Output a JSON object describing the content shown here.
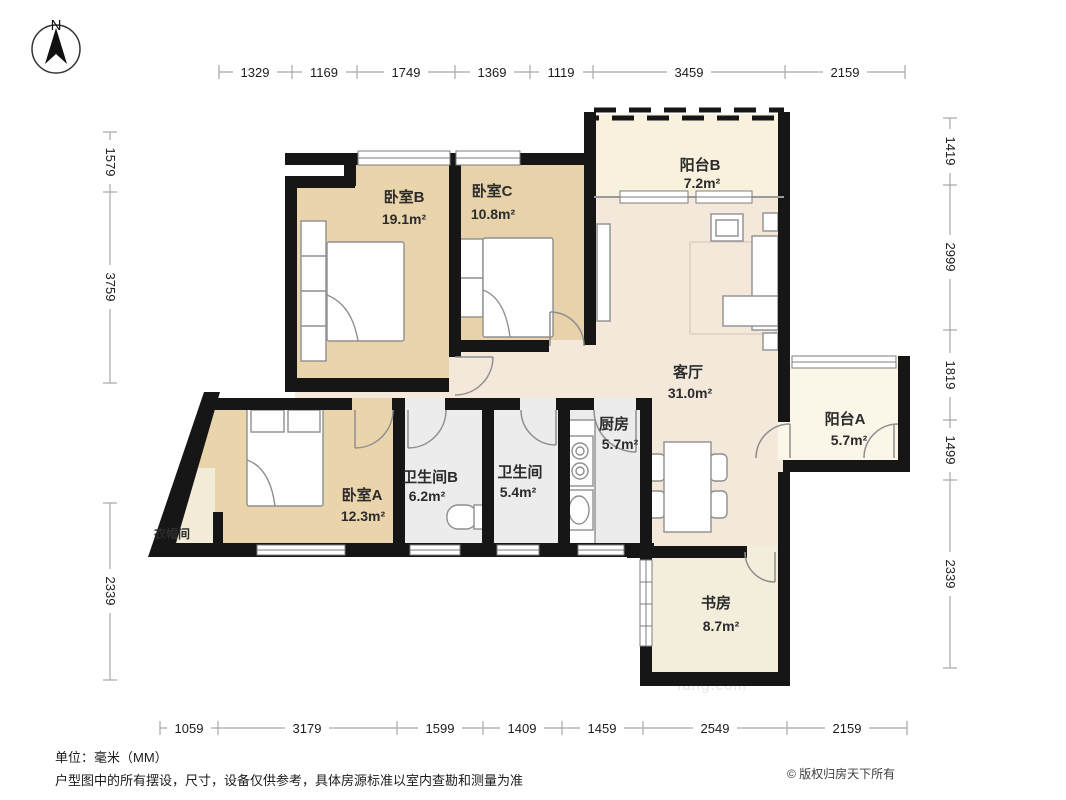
{
  "compass": {
    "north_label": "N"
  },
  "dimensions": {
    "unit_note": "单位：毫米（MM）",
    "top": [
      "1329",
      "1169",
      "1749",
      "1369",
      "1119",
      "3459",
      "2159"
    ],
    "bottom": [
      "1059",
      "3179",
      "1599",
      "1409",
      "1459",
      "2549",
      "2159"
    ],
    "left": [
      "1579",
      "3759",
      "2339"
    ],
    "right": [
      "1419",
      "2999",
      "1819",
      "1499",
      "2339"
    ]
  },
  "rooms": {
    "balcony_b": {
      "name": "阳台B",
      "area": "7.2m²"
    },
    "bedroom_b": {
      "name": "卧室B",
      "area": "19.1m²"
    },
    "bedroom_c": {
      "name": "卧室C",
      "area": "10.8m²"
    },
    "living": {
      "name": "客厅",
      "area": "31.0m²"
    },
    "balcony_a": {
      "name": "阳台A",
      "area": "5.7m²"
    },
    "kitchen": {
      "name": "厨房",
      "area": "5.7m²"
    },
    "bath_b": {
      "name": "卫生间B",
      "area": "6.2m²"
    },
    "bath": {
      "name": "卫生间",
      "area": "5.4m²"
    },
    "bedroom_a": {
      "name": "卧室A",
      "area": "12.3m²"
    },
    "cloakroom": {
      "name": "衣帽间"
    },
    "study": {
      "name": "书房",
      "area": "8.7m²"
    }
  },
  "footer": {
    "unit_label": "单位：毫米（MM）",
    "disclaimer": "户型图中的所有摆设，尺寸，设备仅供参考，具体房源标准以室内查勘和测量为准",
    "copyright": "© 版权归房天下所有"
  },
  "watermark": "fang.com",
  "colors": {
    "wall": "#161616",
    "bedroom_fill": "#e9d4ab",
    "living_fill": "#f3e8da",
    "balcony_fill": "#f7f1dd",
    "service_fill": "#ececec"
  }
}
